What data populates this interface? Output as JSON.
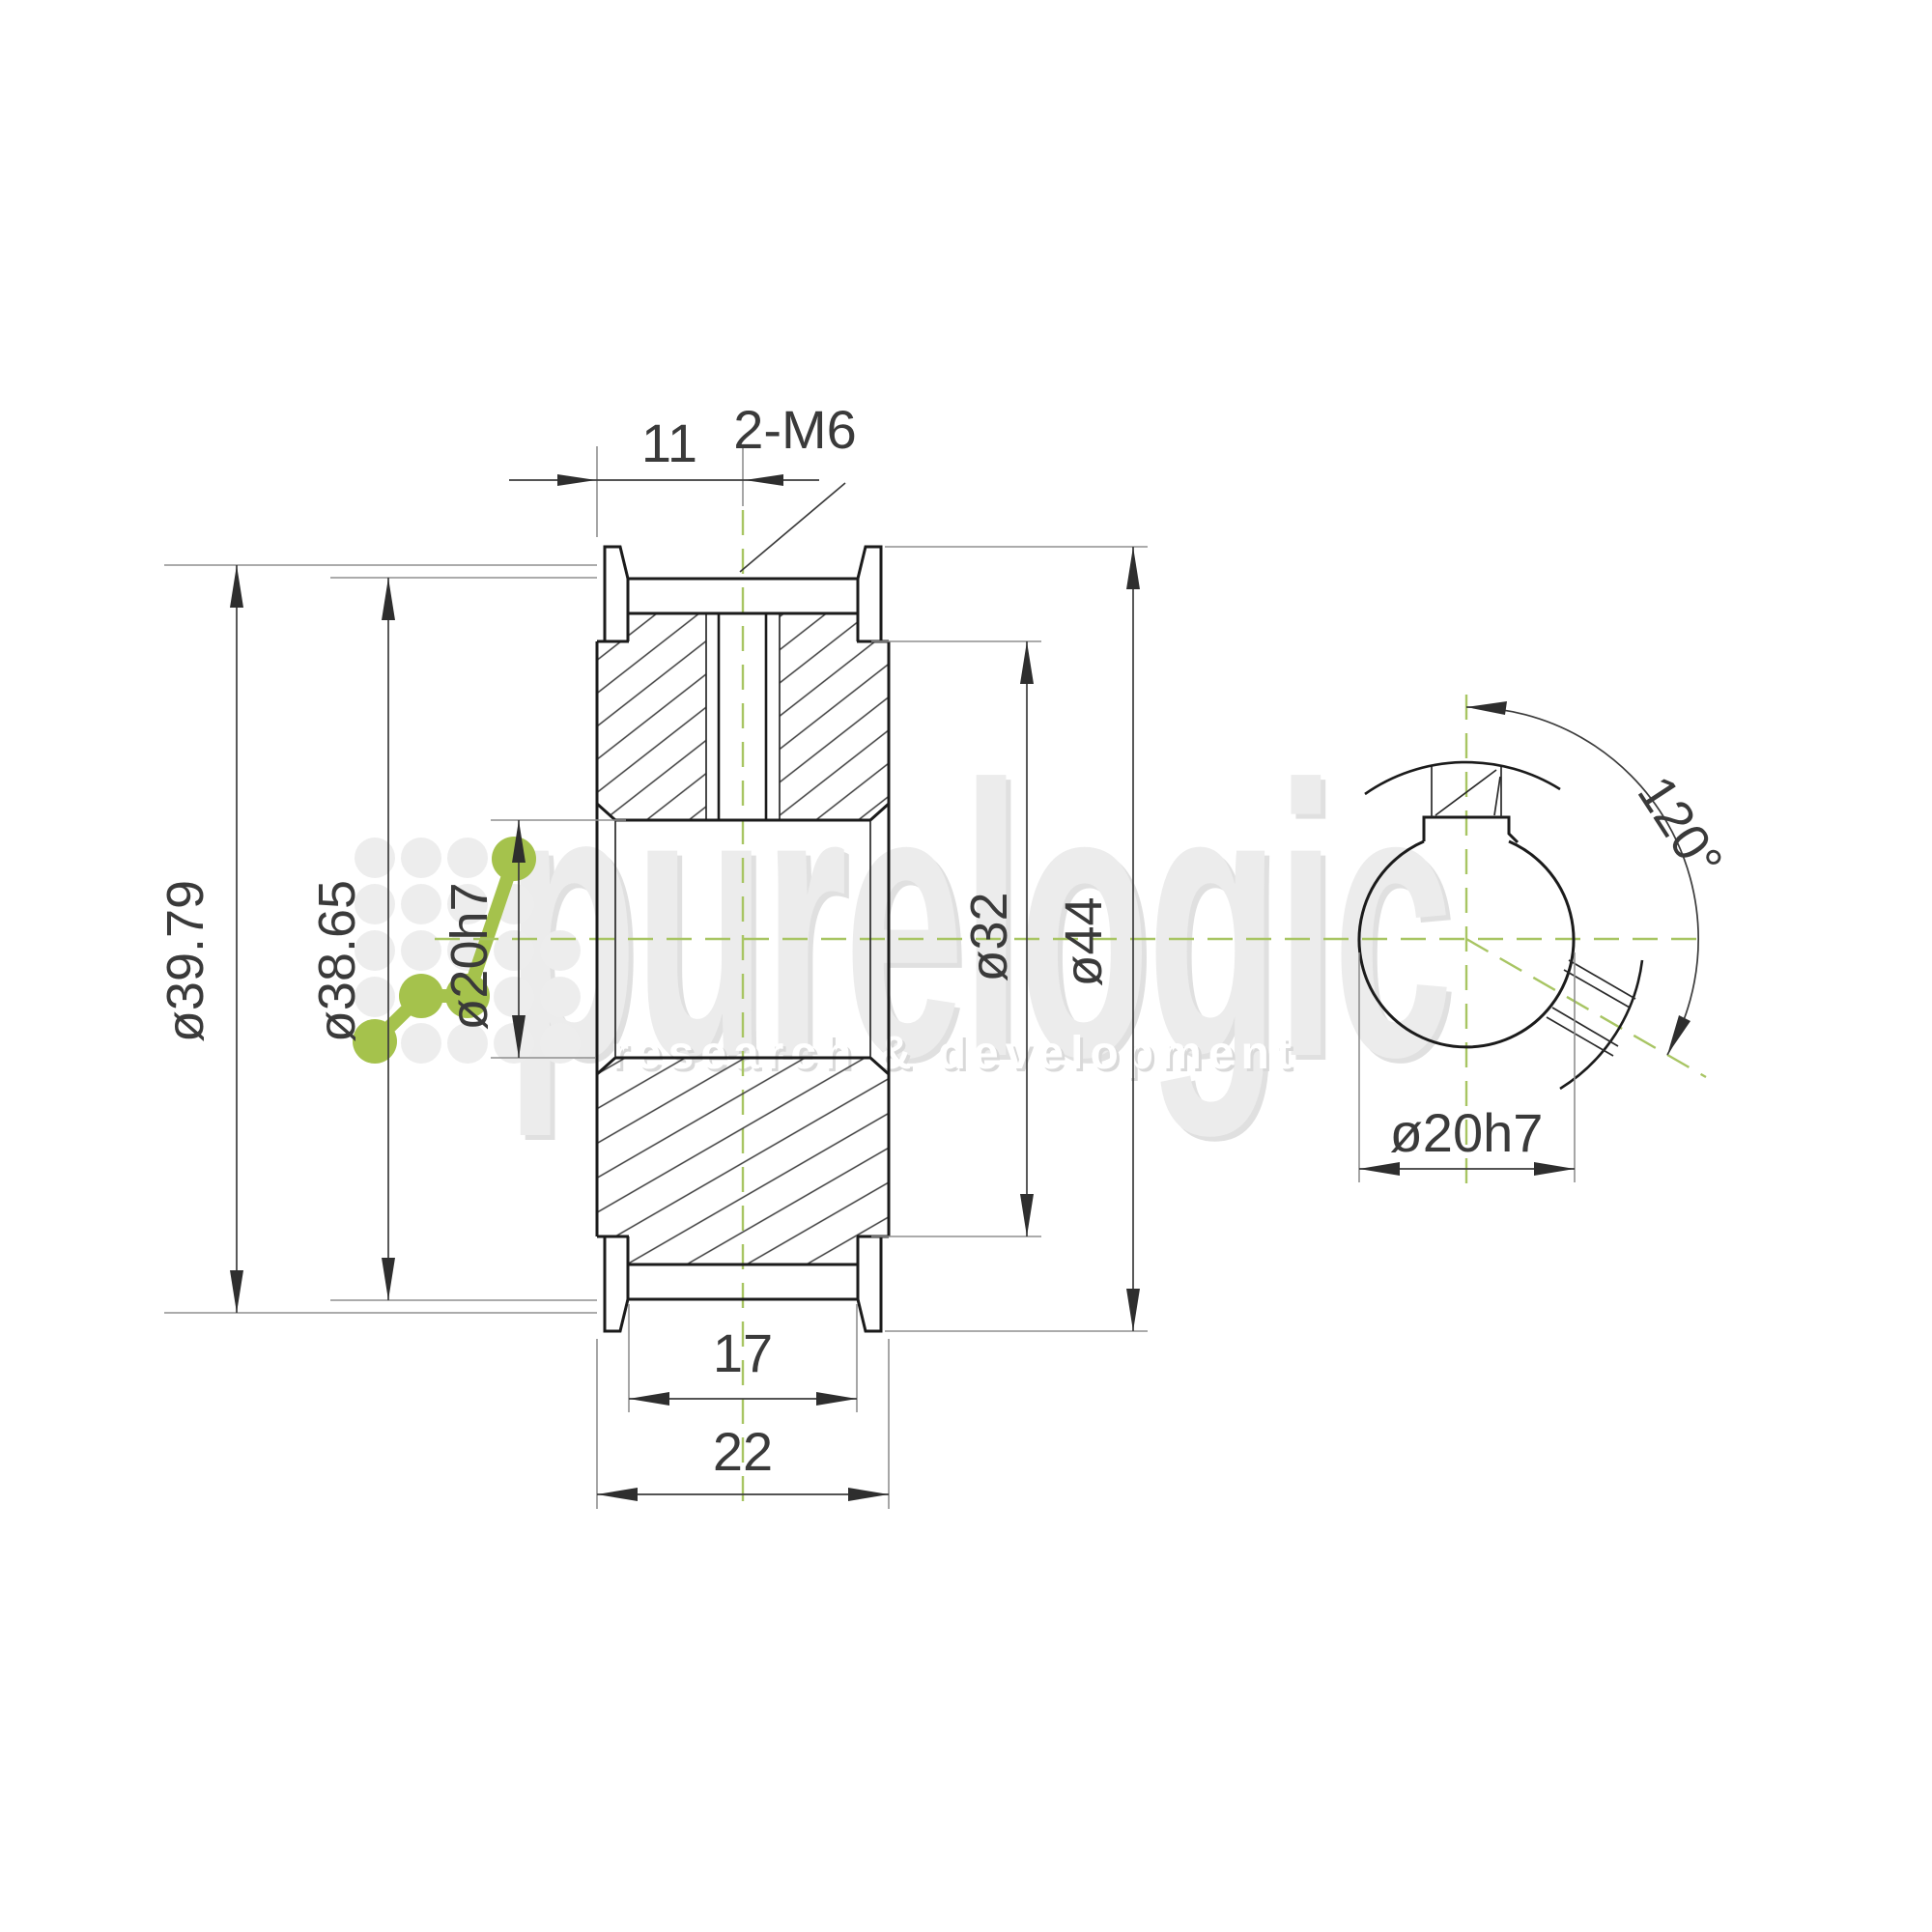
{
  "watermark": {
    "brand": "purelogic",
    "tagline": "research & development"
  },
  "section_view": {
    "dims": {
      "offset_to_center": "11",
      "set_screws": "2-M6",
      "pitch_diameter": "ø39.79",
      "outside_diameter": "ø38.65",
      "bore_diameter": "ø20h7",
      "hub_step_diameter": "ø32",
      "flange_diameter": "ø44",
      "inner_width": "17",
      "overall_width": "22"
    }
  },
  "end_view": {
    "dims": {
      "screw_angle": "120°",
      "bore_diameter": "ø20h7"
    }
  },
  "colors": {
    "accent_green": "#a8c563",
    "outline_dark": "#1b1b1b",
    "dimension_gray": "#8f8f8f",
    "watermark_gray": "#ececec"
  }
}
